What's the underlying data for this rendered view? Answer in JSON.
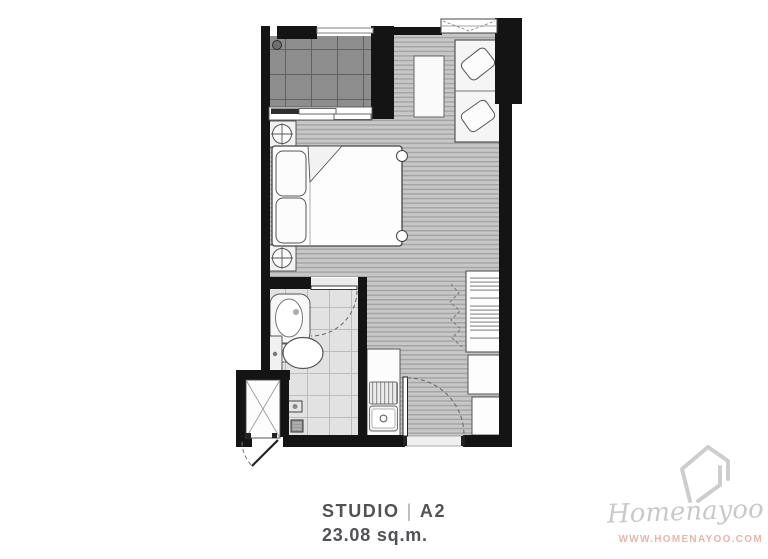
{
  "caption": {
    "unit_type": "STUDIO",
    "separator": "|",
    "unit_code": "A2",
    "area": "23.08 sq.m."
  },
  "watermark": {
    "brand": "Homenayoo",
    "url": "WWW.HOMENAYOO.COM"
  },
  "colors": {
    "wall": "#141414",
    "wood_floor": "#c7c7c7",
    "wood_floor_stripe": "#a5a5a5",
    "balcony_floor": "#8d8d8d",
    "balcony_grid": "#616161",
    "bathroom_tile": "#e2e2e2",
    "bathroom_tile_grid": "#bcbcbc",
    "furniture_fill": "#fdfdfd",
    "furniture_line": "#555555",
    "caption_text": "#515257",
    "caption_separator": "#a9a9ab",
    "watermark_gray": "#c9c9c9",
    "watermark_url_pink": "#eab4ac"
  },
  "plan": {
    "features": [
      "balcony",
      "balcony-floor-drain",
      "sliding-glass-door",
      "window",
      "sofa",
      "coffee-table",
      "double-bed",
      "bed-pillows",
      "nightstand-top",
      "nightstand-bottom",
      "bathroom",
      "wash-basin",
      "toilet",
      "shower-head",
      "floor-drain",
      "bathroom-door",
      "kitchen-counter",
      "kitchen-sink",
      "drying-rack",
      "wardrobe",
      "wardrobe-folding-door",
      "refrigerator-cabinet",
      "shoe-cabinet",
      "entrance-door",
      "service-shaft",
      "shaft-door"
    ]
  }
}
